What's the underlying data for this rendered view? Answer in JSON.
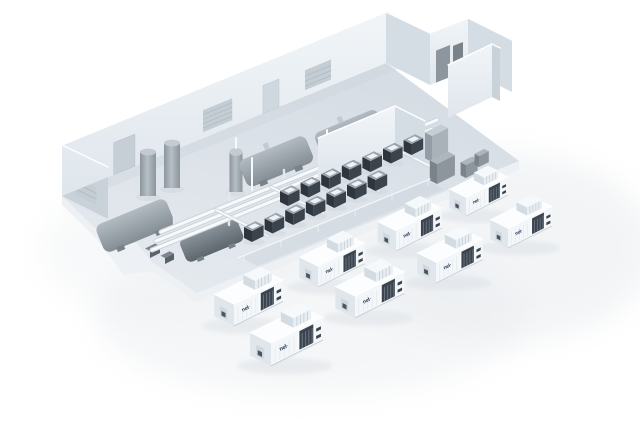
{
  "scene": {
    "subject": "isometric-hydrogen-electrolyser-plant",
    "container_units": 8,
    "electrolyser_stacks": 14,
    "equipment": {
      "vertical_tanks": 2,
      "horizontal_tanks": 2,
      "separator_vessels": 2,
      "control_cabinets": 4,
      "wall_louvers": 3,
      "doors": 2
    }
  },
  "branding": {
    "logo_text": "nel·"
  },
  "colors": {
    "bg": "#ffffff",
    "shadow": "#e9ecef",
    "wall": "#e7edf2",
    "wall_shade": "#d5dde4",
    "wall_dark": "#c9d2d9",
    "floor": "#dce2e8",
    "floor_edge": "#eef1f4",
    "equip": "#9aa2aa",
    "equip_dark": "#3b434c",
    "pipe": "#f7fafc",
    "pipe_case": "#ccd4da",
    "cont_front": "#f4f7fa",
    "cont_end": "#dfe6ec",
    "cont_top": "#fcfdfe",
    "vent": "#3c454f",
    "logo": "#1c2f52"
  }
}
